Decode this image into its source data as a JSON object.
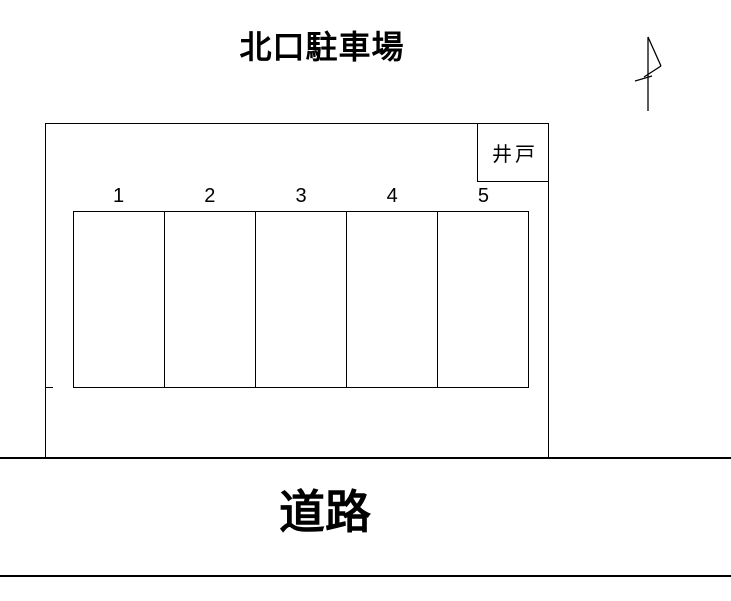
{
  "page": {
    "title": "北口駐車場",
    "road_label": "道路"
  },
  "well": {
    "label": "井戸"
  },
  "parking": {
    "numbers": [
      "1",
      "2",
      "3",
      "4",
      "5"
    ]
  },
  "icons": {
    "north_arrow": "north-arrow-flag"
  },
  "colors": {
    "line": "#000000",
    "background": "#ffffff",
    "text": "#000000"
  }
}
